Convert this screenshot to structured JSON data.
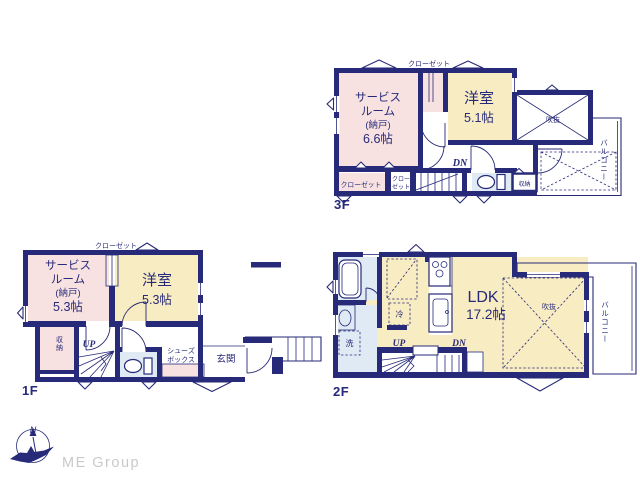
{
  "palette": {
    "wall": "#272a78",
    "pink": "#f8e2e1",
    "cream": "#f8ecc2",
    "blue": "#dfeaf5",
    "muted": "#c9c9c9",
    "bg": "#ffffff"
  },
  "compass": {
    "north_label": "N"
  },
  "brand": {
    "name": "ME Group"
  },
  "floor3": {
    "floor_label": "3F",
    "closet_top": "クローゼット",
    "service_room_l1": "サービス",
    "service_room_l2": "ルーム",
    "service_room_l3": "(納戸)",
    "service_room_l4": "6.6帖",
    "bedroom_name": "洋室",
    "bedroom_size": "5.1帖",
    "void_label": "吹抜",
    "balcony_label": "バルコニー",
    "closet_a": "クローゼット",
    "closet_b_l1": "クロー",
    "closet_b_l2": "ゼット",
    "down_label": "DN",
    "storage_label": "収納"
  },
  "floor1": {
    "floor_label": "1F",
    "closet_top": "クローゼット",
    "service_room_l1": "サービス",
    "service_room_l2": "ルーム",
    "service_room_l3": "(納戸)",
    "service_room_l4": "5.3帖",
    "bedroom_name": "洋室",
    "bedroom_size": "5.3帖",
    "storage_label": "収納",
    "up_label": "UP",
    "shoes_l1": "シューズ",
    "shoes_l2": "ボックス",
    "entrance_label": "玄関"
  },
  "floor2": {
    "floor_label": "2F",
    "ldk_name": "LDK",
    "ldk_size": "17.2帖",
    "void_label": "吹抜",
    "balcony_label": "バルコニー",
    "fridge_label": "冷",
    "washer_label": "洗",
    "up_label": "UP",
    "down_label": "DN"
  }
}
